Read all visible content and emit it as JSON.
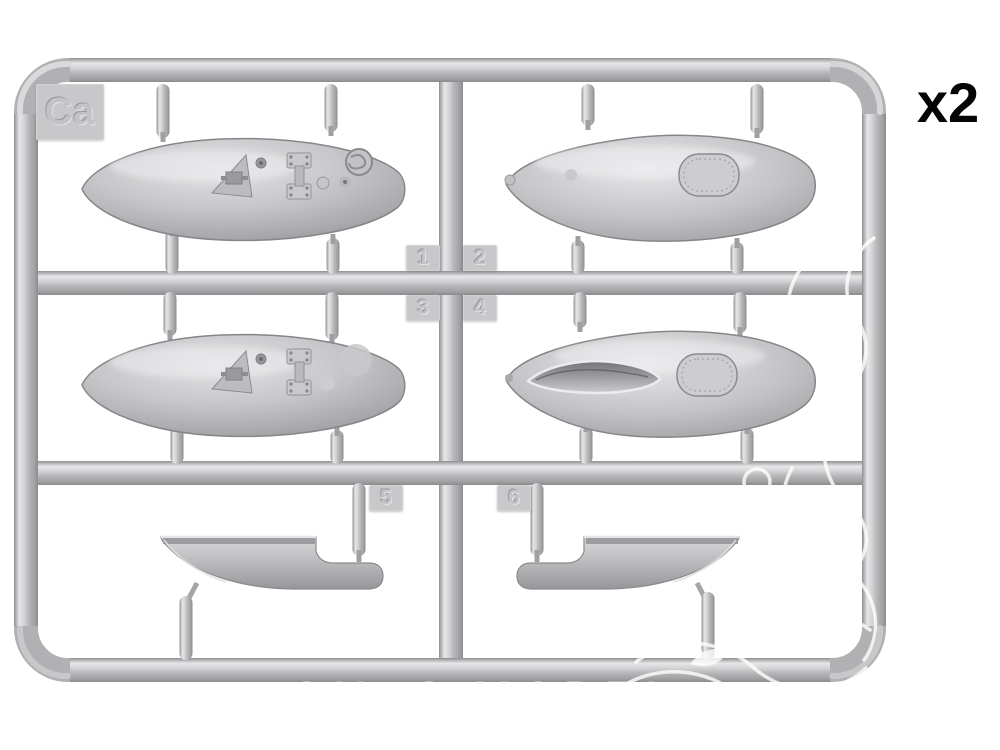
{
  "photo": {
    "type": "model-kit-sprue-product-photo",
    "background_color": "#ffffff",
    "plastic_color": "#b6b6b8",
    "plastic_highlight": "#e6e6e8",
    "plastic_shadow": "#8e8e91"
  },
  "sprue": {
    "gate_letter": "Ca",
    "quantity_label": "x2",
    "part_numbers": [
      "1",
      "2",
      "3",
      "4",
      "5",
      "6"
    ],
    "parts": [
      {
        "number": "1",
        "description": "teardrop fuel-tank half with hatches, filler cap and fairing detail",
        "position": "top-left"
      },
      {
        "number": "2",
        "description": "smooth teardrop fuel-tank half with oval riveted access panel",
        "position": "top-right"
      },
      {
        "number": "3",
        "description": "teardrop fuel-tank half with hatches and fairing detail, variant",
        "position": "middle-left"
      },
      {
        "number": "4",
        "description": "teardrop fuel-tank half with open lens-shaped slot and oval panel",
        "position": "middle-right"
      },
      {
        "number": "5",
        "description": "scoop / hull-shaped fairing with side tube, facing right",
        "position": "bottom-left"
      },
      {
        "number": "6",
        "description": "scoop / hull-shaped fairing with side tube, facing left (mirror)",
        "position": "bottom-right"
      }
    ]
  },
  "watermark": {
    "shop_text": "OUPS MODEL",
    "ornament": "white floral swirl overlay on right side and bottom bar",
    "color": "#ffffff"
  }
}
